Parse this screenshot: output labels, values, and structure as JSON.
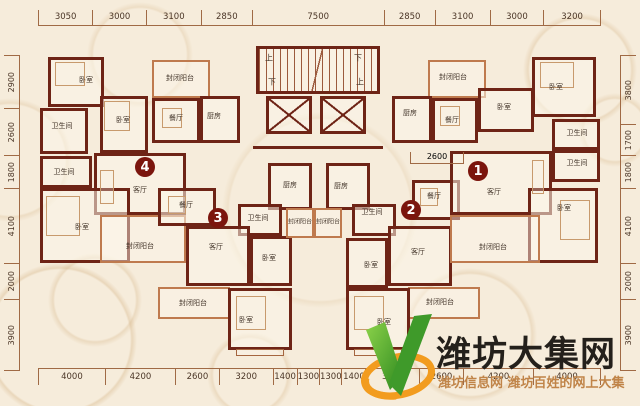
{
  "plan": {
    "dims": {
      "top": [
        "3050",
        "3000",
        "3100",
        "2850",
        "7500",
        "2850",
        "3100",
        "3000",
        "3200"
      ],
      "bottom": [
        "4000",
        "4200",
        "2600",
        "3200",
        "1400",
        "1300",
        "1300",
        "1400",
        "3200",
        "2600",
        "4200",
        "4000"
      ],
      "left": [
        "2900",
        "2600",
        "1800",
        "4100",
        "2000",
        "3900"
      ],
      "right": [
        "3800",
        "1700",
        "1800",
        "4100",
        "2000",
        "3900"
      ],
      "interior_dim": "2600"
    },
    "unit_badges": [
      "1",
      "2",
      "3",
      "4"
    ],
    "core": {
      "up": "上",
      "down": "下"
    },
    "rooms": [
      "卧室",
      "卫生间",
      "卧室",
      "封闭阳台",
      "餐厅",
      "厨房",
      "卫生间",
      "客厅",
      "卧室",
      "封闭阳台",
      "餐厅",
      "厨房",
      "卫生间",
      "客厅",
      "卧室",
      "封闭阳台",
      "封闭阳台",
      "卧室",
      "餐厅",
      "厨房",
      "卫生间",
      "客厅",
      "卧室",
      "封闭阳台",
      "封闭阳台",
      "卧室",
      "封闭阳台",
      "厨房",
      "餐厅",
      "卧室",
      "卧室",
      "卫生间",
      "卫生间",
      "客厅",
      "卧室",
      "封闭阳台"
    ],
    "colors": {
      "wall": "#6e2416",
      "light_wall": "#bf7a4e",
      "badge": "#7b150d",
      "background": "#f6ecdb"
    }
  },
  "watermark": {
    "site_name": "潍坊大集网",
    "tagline": "潍坊信息网 潍坊百姓的网上大集",
    "logo_colors": {
      "green": "#4aa637",
      "orange": "#f29c1f"
    }
  }
}
